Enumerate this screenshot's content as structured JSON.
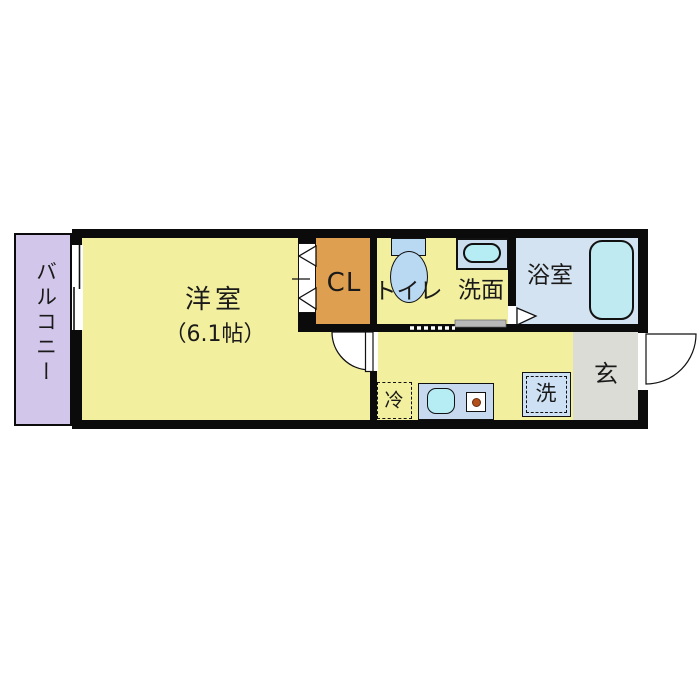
{
  "floor_plan": {
    "type": "japanese-apartment-1K",
    "rooms": {
      "balcony": {
        "label": "バルコニー"
      },
      "western_room": {
        "label": "洋室",
        "size": "（6.1帖）"
      },
      "closet": {
        "label": "CL"
      },
      "toilet": {
        "label": "トイレ"
      },
      "washroom": {
        "label": "洗面"
      },
      "bathroom": {
        "label": "浴室"
      },
      "entrance": {
        "label": "玄"
      }
    },
    "fixtures": {
      "refrigerator_space": {
        "label": "冷"
      },
      "washing_machine": {
        "label": "洗"
      },
      "bathtub": {
        "icon": "bathtub-icon"
      },
      "toilet_unit": {
        "icon": "toilet-icon"
      },
      "vanity_sink": {
        "icon": "sink-icon"
      },
      "kitchen_sink": {
        "icon": "sink-icon"
      },
      "stove": {
        "icon": "stove-burner-icon"
      }
    },
    "colors": {
      "room_yellow": "#f2ef9e",
      "balcony_lavender": "#d2c7ea",
      "closet_orange": "#de9f50",
      "bathroom_blue": "#d4e3f1",
      "fixture_blue": "#b9d8f2",
      "water_cyan": "#b6ecf4",
      "entrance_gray": "#dcdcd6",
      "wall_black": "#0b0b0b"
    }
  }
}
